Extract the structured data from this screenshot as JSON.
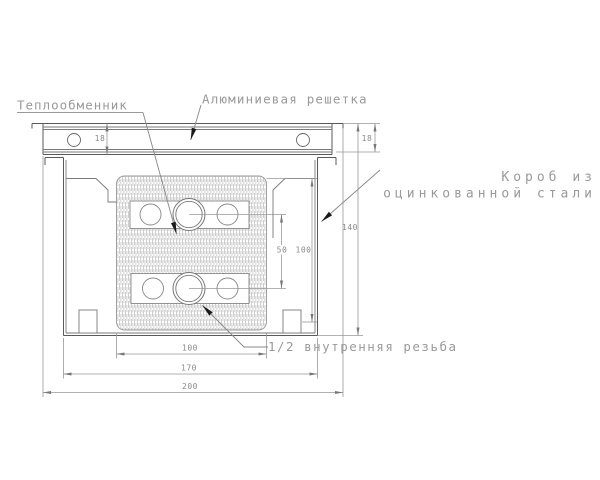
{
  "drawing": {
    "labels": {
      "heat_exchanger": "Теплообменник",
      "aluminum_grille": "Алюминиевая решетка",
      "steel_box_line1": "Короб из",
      "steel_box_line2": "оцинкованной стали",
      "thread": "1/2 внутренняя резьба"
    },
    "dimensions": {
      "grille_height_left": "18",
      "grille_height_right": "18",
      "overall_height": "140",
      "inner_height": "100",
      "pipe_spacing": "50",
      "exchanger_width": "100",
      "box_width": "170",
      "grille_width": "200"
    },
    "colors": {
      "outline": "#5a5a5a",
      "dim_lines": "#999999",
      "label_text": "#9a9a9a",
      "hatch": "#c3c3c3",
      "leader_arrow": "#1a1a1a",
      "background": "#ffffff"
    }
  }
}
